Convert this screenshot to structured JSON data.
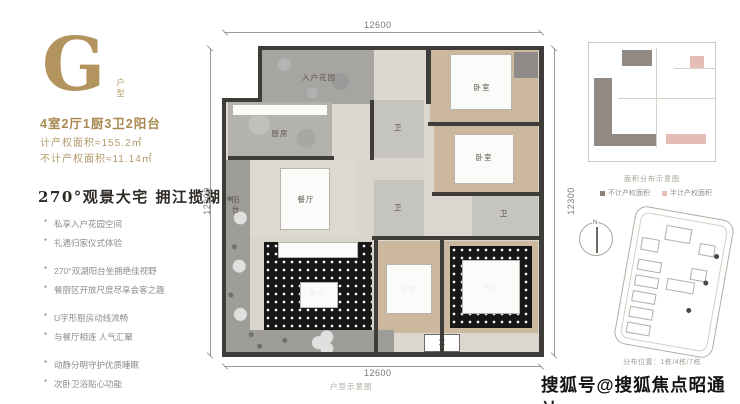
{
  "left_panel": {
    "type_letter": "G",
    "type_label": "户型",
    "layout_spec": "4室2厅1厨3卫2阳台",
    "area_line1": "计产权面积≈155.2㎡",
    "area_line2": "不计产权面积≈11.14㎡",
    "headline": "270°观景大宅 拥江揽湖",
    "bullets": [
      "私享入户花园空间",
      "礼遇归家仪式体验",
      "270°双湖阳台坐拥绝佳视野",
      "餐厨区开放尺度尽享会客之趣",
      "U字形厨房动线流畅",
      "与餐厅相连 人气汇聚",
      "动静分明守护优质睡眠",
      "次卧卫浴贴心功能"
    ]
  },
  "floor_plan": {
    "dim_top": "12600",
    "dim_bottom": "12600",
    "dim_left": "12300",
    "dim_right": "12300",
    "rooms": {
      "entry_garden": "入户花园",
      "kitchen": "厨房",
      "dining": "餐厅",
      "living": "客厅",
      "balcony": "阳台",
      "bedroom_top": "卧室",
      "bedroom_mid": "卧室",
      "bedroom_bottom": "卧室",
      "master": "主卧",
      "bath_top": "卫",
      "bath_center": "卫",
      "bath_right": "卫"
    },
    "caption": "户型示意图"
  },
  "sidebar": {
    "area_diagram": {
      "caption": "面积分布示意图",
      "legend": [
        {
          "label": "不计产权面积",
          "color": "#8a827b"
        },
        {
          "label": "半计产权面积",
          "color": "#e6bcb6"
        }
      ]
    },
    "location_diagram": {
      "compass_label": "N",
      "caption": "分布位置：1栋/4栋/7栋"
    }
  },
  "watermark": {
    "text": "搜狐号@搜狐焦点昭通站"
  },
  "colors": {
    "gold": "#ab8e5f",
    "headline_text": "#2e2a26",
    "wall": "#3f3d3a",
    "bedroom_floor": "#cbb89f",
    "legend_dark": "#8a827b",
    "legend_pink": "#e6bcb6"
  }
}
